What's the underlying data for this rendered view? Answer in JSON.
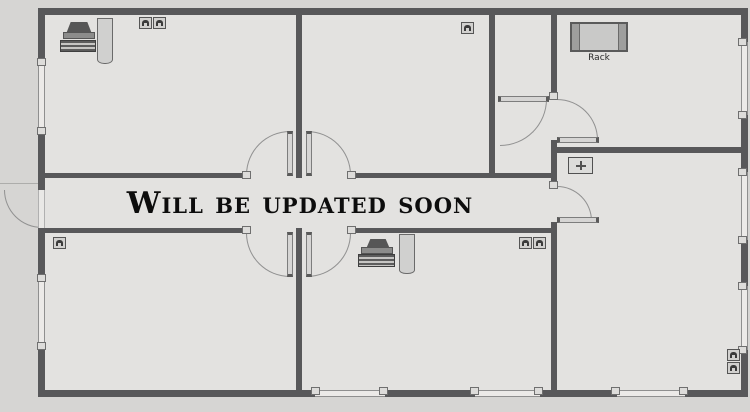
{
  "watermark": {
    "text": "Will be updated soon"
  },
  "rack": {
    "label": "Rack"
  },
  "colors": {
    "outside_bg": "#d6d5d3",
    "room_bg": "#e3e2e0",
    "wall": "#58585a",
    "window_frame": "#8f8f8f",
    "door_arc": "#919191",
    "watermark_text": "#0d0d0d",
    "furniture_fill": "#d0d0cf",
    "rack_fill": "#c9c9c8",
    "rack_side_bars": "#9e9e9d",
    "device_dark": "#3b3b3b"
  },
  "icons": {
    "workstation": "desk-with-monitor-and-keyboard",
    "rack": "server-rack-rectangle",
    "wall_port": "arch-port-square",
    "vent": "plus-cross-box",
    "door": "quarter-circle-swing-arc",
    "window": "double-line-wall-segment"
  }
}
